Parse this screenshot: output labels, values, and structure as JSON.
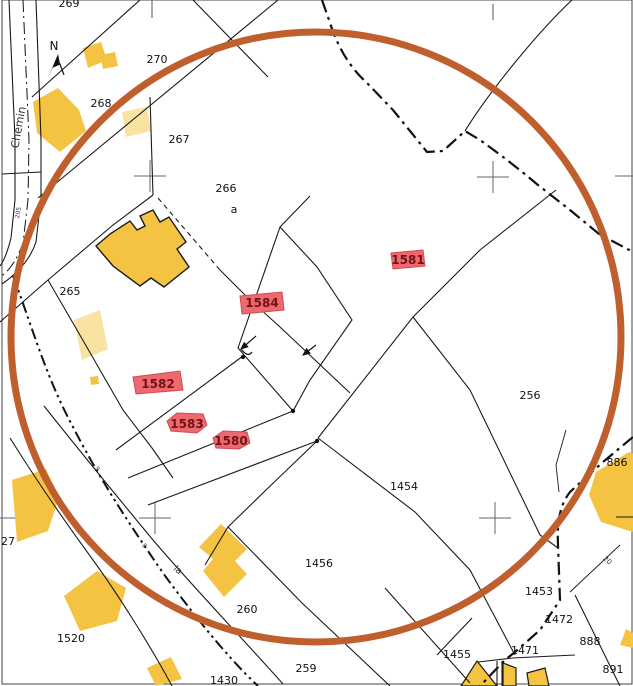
{
  "map": {
    "type": "cadastral-map",
    "compass_label": "N",
    "street_label": "Chemin",
    "colors": {
      "background": "#ffffff",
      "parcel_line": "#1a1a1a",
      "survey_cross": "#666666",
      "selection_circle": "#c05f2e",
      "building_yellow": "#f5c342",
      "building_cream": "#fae3a2",
      "highlight_fill": "#ee686d",
      "highlight_stroke": "#c94f55",
      "highlight_text": "#701318"
    },
    "selection_circle": {
      "cx": 316,
      "cy": 337,
      "r": 305,
      "stroke_width": 7
    },
    "parcel_labels": [
      {
        "text": "269",
        "x": 69,
        "y": 7
      },
      {
        "text": "270",
        "x": 157,
        "y": 63
      },
      {
        "text": "268",
        "x": 101,
        "y": 107
      },
      {
        "text": "267",
        "x": 179,
        "y": 143
      },
      {
        "text": "266",
        "x": 226,
        "y": 192
      },
      {
        "text": "a",
        "x": 234,
        "y": 213,
        "size": 10
      },
      {
        "text": "265",
        "x": 70,
        "y": 295
      },
      {
        "text": "256",
        "x": 530,
        "y": 399
      },
      {
        "text": "1454",
        "x": 404,
        "y": 490
      },
      {
        "text": "1456",
        "x": 319,
        "y": 567
      },
      {
        "text": "260",
        "x": 247,
        "y": 613
      },
      {
        "text": "1520",
        "x": 71,
        "y": 642
      },
      {
        "text": "259",
        "x": 306,
        "y": 672
      },
      {
        "text": "1430",
        "x": 224,
        "y": 684
      },
      {
        "text": "1455",
        "x": 457,
        "y": 658
      },
      {
        "text": "1471",
        "x": 525,
        "y": 654
      },
      {
        "text": "1472",
        "x": 559,
        "y": 623
      },
      {
        "text": "888",
        "x": 590,
        "y": 645
      },
      {
        "text": "891",
        "x": 613,
        "y": 673
      },
      {
        "text": "886",
        "x": 617,
        "y": 466
      },
      {
        "text": "1453",
        "x": 539,
        "y": 595
      },
      {
        "text": "27",
        "x": 8,
        "y": 545
      }
    ],
    "tiny_labels": [
      {
        "text": "Chemin",
        "x": 22,
        "y": 128,
        "rot": -80,
        "size": 11
      },
      {
        "text": "205",
        "x": 20,
        "y": 213,
        "rot": -80,
        "size": 6
      },
      {
        "text": "la",
        "x": 176,
        "y": 572,
        "rot": 42,
        "size": 9
      },
      {
        "text": "20",
        "x": 606,
        "y": 562,
        "rot": 42,
        "size": 7
      },
      {
        "text": "9",
        "x": 96,
        "y": 470,
        "rot": 50,
        "size": 6
      },
      {
        "text": "8",
        "x": 143,
        "y": 547,
        "rot": 50,
        "size": 6
      }
    ],
    "highlighted_parcels": [
      {
        "label": "1581",
        "points": "391,253 423,250 425,266 393,269",
        "lx": 408,
        "ly": 264
      },
      {
        "label": "1584",
        "points": "240,296 282,292 284,310 242,314",
        "lx": 262,
        "ly": 307
      },
      {
        "label": "1582",
        "points": "133,377 180,371 183,390 136,394",
        "lx": 158,
        "ly": 388
      },
      {
        "label": "1583",
        "points": "167,421 177,413 203,414 207,425 197,433 171,431",
        "lx": 187,
        "ly": 428
      },
      {
        "label": "1580",
        "points": "213,438 223,431 247,432 250,443 239,449 216,448",
        "lx": 231,
        "ly": 445
      }
    ]
  }
}
